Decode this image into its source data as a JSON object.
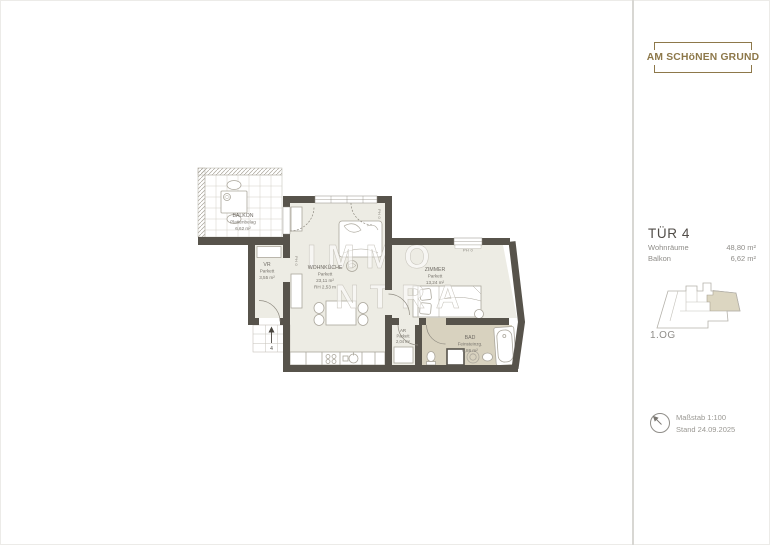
{
  "brand": {
    "name": "AM SCHöNEN GRUND"
  },
  "unit": {
    "title": "TÜR 4",
    "rows": [
      {
        "label": "Wohnräume",
        "value": "48,80 m²"
      },
      {
        "label": "Balkon",
        "value": "6,62 m²"
      }
    ],
    "floor_label": "1.OG"
  },
  "footer": {
    "scale": "Maßstab 1:100",
    "date": "Stand 24.09.2025"
  },
  "plan": {
    "watermark": {
      "line1": "IMMO",
      "line2": "NTRA"
    },
    "annotations": {
      "parapet": "PH 0",
      "entrance_number": "4"
    },
    "rooms": [
      {
        "name": "BALKON",
        "finish": "Plattenbelag",
        "area": "6,62 m²"
      },
      {
        "name": "VR",
        "finish": "Parkett",
        "area": "3,55 m²"
      },
      {
        "name": "WOHNKÜCHE",
        "finish": "Parkett",
        "area": "23,11 m²",
        "height": "RH 2,53 m"
      },
      {
        "name": "ZIMMER",
        "finish": "Parkett",
        "area": "13,24 m²"
      },
      {
        "name": "AR",
        "finish": "Parkett",
        "area": "2,04 m²"
      },
      {
        "name": "BAD",
        "finish": "Feinsteinzg.",
        "area": "6,86 m²"
      }
    ],
    "colors": {
      "wall": "#57534b",
      "floor": "#edece4",
      "bath_floor": "#d8d2bf"
    }
  }
}
